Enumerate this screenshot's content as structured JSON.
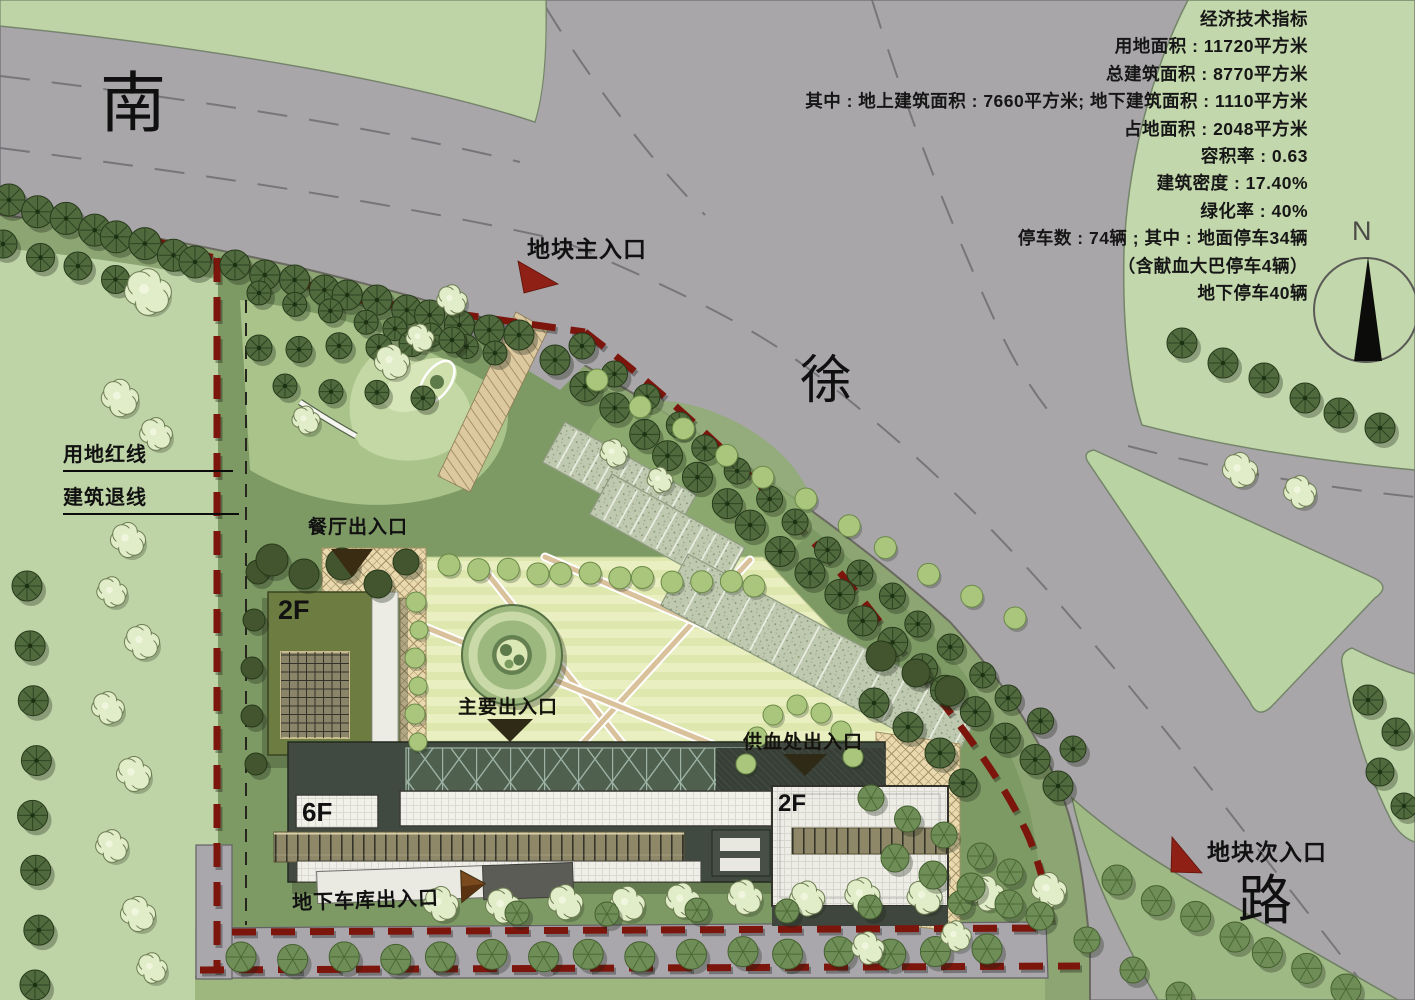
{
  "indicators": {
    "lines": [
      "经济技术指标",
      "用地面积 : 11720平方米",
      "总建筑面积 : 8770平方米",
      "其中 : 地上建筑面积 : 7660平方米; 地下建筑面积 : 1110平方米",
      "占地面积 : 2048平方米",
      "容积率 : 0.63",
      "建筑密度 : 17.40%",
      "绿化率 : 40%",
      "停车数 : 74辆 ; 其中 : 地面停车34辆",
      "（含献血大巴停车4辆）",
      "地下停车40辆"
    ]
  },
  "road_name": {
    "char1": "南",
    "char2": "徐",
    "char3": "路"
  },
  "labels": {
    "main_entrance": "地块主入口",
    "secondary_entrance": "地块次入口",
    "land_red_line": "用地红线",
    "building_setback_line": "建筑退线",
    "canteen_entrance": "餐厅出入口",
    "main_building_entrance": "主要出入口",
    "blood_supply_entrance": "供血处出入口",
    "garage_entrance": "地下车库出入口"
  },
  "buildings": {
    "canteen_floors": "2F",
    "main_floors": "6F",
    "clinic_floors": "2F"
  },
  "compass": {
    "north": "N"
  },
  "colors": {
    "road": "#a8a6a9",
    "greenland": "#bed3a6",
    "site_lawn": "#7e9a64",
    "red_line": "#7c150c",
    "entrance_arrow": "#8e2016",
    "plaza_stripe": "#e9efc0"
  }
}
